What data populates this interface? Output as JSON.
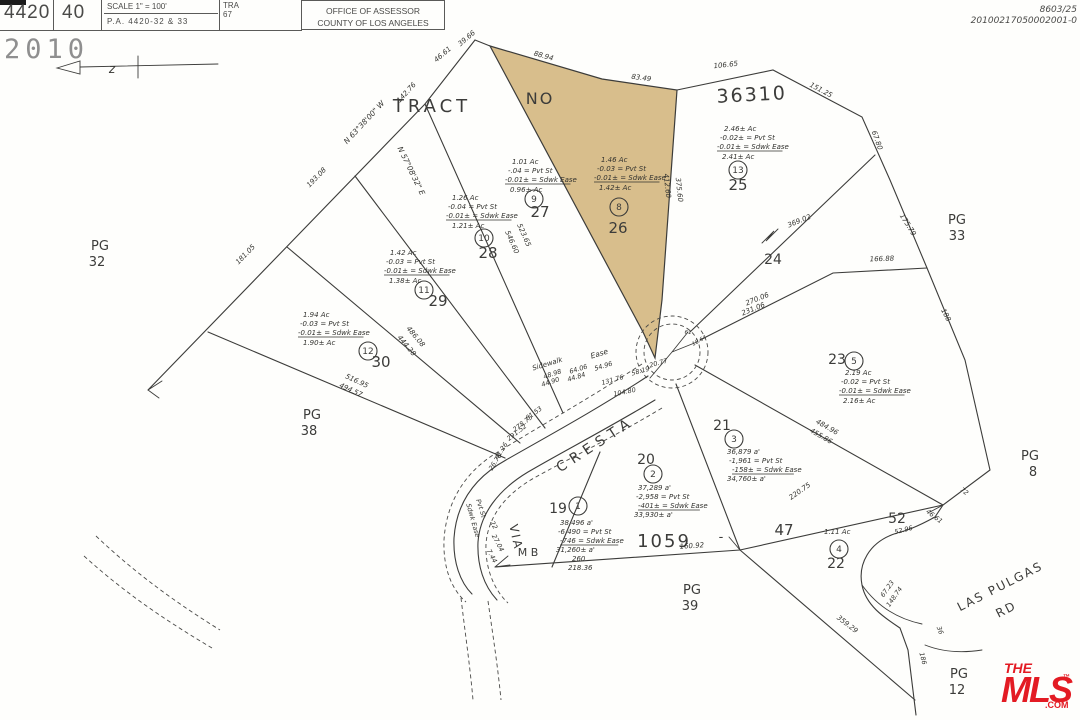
{
  "header": {
    "book": "4420",
    "page": "40",
    "scale": "SCALE 1\" = 100'",
    "pa": "P.A.  4420-32 & 33",
    "tra_label": "TRA",
    "tra_value": "67",
    "office_line1": "OFFICE OF ASSESSOR",
    "office_line2": "COUNTY OF LOS ANGELES"
  },
  "stamp": {
    "year": "2010"
  },
  "doc_numbers": {
    "line1": "8603/25",
    "line2": "20100217050002001-0"
  },
  "mls_logo": {
    "the": "THE",
    "mls": "MLS",
    "tm": "™",
    "com": ".COM",
    "color": "#e31b23"
  },
  "map": {
    "highlight_color": "#d8be8c",
    "line_color": "#3c3c3a",
    "labels": [
      {
        "t": "TRACT",
        "x": 432,
        "y": 112,
        "fs": 18,
        "p": true,
        "ls": 4,
        "a": "m",
        "n": "tract-word"
      },
      {
        "t": "NO",
        "x": 540,
        "y": 104,
        "fs": 16,
        "p": true,
        "ls": 2,
        "a": "m",
        "n": "tract-no-word"
      },
      {
        "t": "36310",
        "x": 752,
        "y": 101,
        "fs": 19,
        "p": true,
        "ls": 2,
        "r": -3,
        "a": "m",
        "n": "tract-number"
      },
      {
        "t": "PG",
        "x": 100,
        "y": 250,
        "fs": 13,
        "p": true,
        "a": "m"
      },
      {
        "t": "32",
        "x": 97,
        "y": 266,
        "fs": 13,
        "p": true,
        "a": "m"
      },
      {
        "t": "PG",
        "x": 957,
        "y": 224,
        "fs": 13,
        "p": true,
        "a": "m"
      },
      {
        "t": "33",
        "x": 957,
        "y": 240,
        "fs": 13,
        "p": true,
        "a": "m"
      },
      {
        "t": "PG",
        "x": 312,
        "y": 419,
        "fs": 13,
        "p": true,
        "a": "m"
      },
      {
        "t": "38",
        "x": 309,
        "y": 435,
        "fs": 13,
        "p": true,
        "a": "m"
      },
      {
        "t": "PG",
        "x": 692,
        "y": 594,
        "fs": 13,
        "p": true,
        "a": "m"
      },
      {
        "t": "39",
        "x": 690,
        "y": 610,
        "fs": 13,
        "p": true,
        "a": "m"
      },
      {
        "t": "PG",
        "x": 1030,
        "y": 460,
        "fs": 13,
        "p": true,
        "a": "m"
      },
      {
        "t": "8",
        "x": 1033,
        "y": 476,
        "fs": 13,
        "p": true,
        "a": "m"
      },
      {
        "t": "PG",
        "x": 959,
        "y": 678,
        "fs": 13,
        "p": true,
        "a": "m"
      },
      {
        "t": "12",
        "x": 957,
        "y": 694,
        "fs": 13,
        "p": true,
        "a": "m"
      },
      {
        "t": "24",
        "x": 773,
        "y": 264,
        "fs": 14,
        "p": true,
        "a": "m",
        "n": "lot-24-number"
      },
      {
        "t": "25",
        "x": 738,
        "y": 190,
        "fs": 15,
        "p": true,
        "a": "m",
        "n": "lot-25-number"
      },
      {
        "t": "26",
        "x": 618,
        "y": 233,
        "fs": 15,
        "p": true,
        "a": "m",
        "n": "lot-26-number"
      },
      {
        "t": "27",
        "x": 540,
        "y": 217,
        "fs": 15,
        "p": true,
        "a": "m",
        "n": "lot-27-number"
      },
      {
        "t": "28",
        "x": 488,
        "y": 258,
        "fs": 15,
        "p": true,
        "a": "m",
        "n": "lot-28-number"
      },
      {
        "t": "29",
        "x": 438,
        "y": 306,
        "fs": 15,
        "p": true,
        "a": "m",
        "n": "lot-29-number"
      },
      {
        "t": "30",
        "x": 381,
        "y": 367,
        "fs": 15,
        "p": true,
        "a": "m",
        "n": "lot-30-number"
      },
      {
        "t": "23",
        "x": 837,
        "y": 364,
        "fs": 14,
        "p": true,
        "a": "m",
        "n": "lot-23-number"
      },
      {
        "t": "22",
        "x": 836,
        "y": 568,
        "fs": 14,
        "p": true,
        "a": "m",
        "n": "lot-22-number"
      },
      {
        "t": "19",
        "x": 558,
        "y": 513,
        "fs": 14,
        "p": true,
        "a": "m",
        "n": "lot-19-number"
      },
      {
        "t": "20",
        "x": 646,
        "y": 464,
        "fs": 14,
        "p": true,
        "a": "m",
        "n": "lot-20-number"
      },
      {
        "t": "21",
        "x": 722,
        "y": 430,
        "fs": 14,
        "p": true,
        "a": "m",
        "n": "lot-21-number"
      },
      {
        "t": "47",
        "x": 784,
        "y": 535,
        "fs": 15,
        "p": true,
        "a": "m"
      },
      {
        "t": "52",
        "x": 897,
        "y": 523,
        "fs": 14,
        "p": true,
        "a": "m"
      },
      {
        "t": "1059",
        "x": 664,
        "y": 547,
        "fs": 18,
        "p": true,
        "ls": 2,
        "a": "m",
        "n": "map-book-number-1059"
      },
      {
        "t": "M B",
        "x": 528,
        "y": 556,
        "fs": 11,
        "p": true,
        "a": "m",
        "n": "map-book-label"
      },
      {
        "t": "-",
        "x": 721,
        "y": 541,
        "fs": 13,
        "p": true,
        "a": "m"
      },
      {
        "t": "VIA",
        "x": 512,
        "y": 538,
        "fs": 12,
        "p": true,
        "r": 78,
        "ls": 2,
        "a": "m",
        "n": "street-via"
      },
      {
        "t": "CRESTA",
        "x": 598,
        "y": 448,
        "fs": 14,
        "p": true,
        "r": -33,
        "ls": 6,
        "a": "m",
        "n": "street-cresta"
      },
      {
        "t": "LAS PULGAS",
        "x": 1002,
        "y": 590,
        "fs": 12,
        "p": true,
        "r": -27,
        "ls": 2,
        "a": "m",
        "n": "street-las-pulgas"
      },
      {
        "t": "RD",
        "x": 1008,
        "y": 613,
        "fs": 12,
        "p": true,
        "r": -27,
        "ls": 2,
        "a": "m"
      },
      {
        "t": "z",
        "x": 112,
        "y": 73,
        "fs": 12,
        "a": "m"
      },
      {
        "t": "9",
        "x": 534,
        "y": 202,
        "fs": 9,
        "p": true,
        "a": "m",
        "c": 9
      },
      {
        "t": "8",
        "x": 619,
        "y": 210,
        "fs": 9,
        "p": true,
        "a": "m",
        "c": 9
      },
      {
        "t": "13",
        "x": 738,
        "y": 173,
        "fs": 9,
        "p": true,
        "a": "m",
        "c": 9
      },
      {
        "t": "10",
        "x": 484,
        "y": 241,
        "fs": 9,
        "p": true,
        "a": "m",
        "c": 9
      },
      {
        "t": "11",
        "x": 424,
        "y": 293,
        "fs": 9,
        "p": true,
        "a": "m",
        "c": 9
      },
      {
        "t": "12",
        "x": 368,
        "y": 354,
        "fs": 9,
        "p": true,
        "a": "m",
        "c": 9
      },
      {
        "t": "5",
        "x": 854,
        "y": 364,
        "fs": 9,
        "p": true,
        "a": "m",
        "c": 9
      },
      {
        "t": "4",
        "x": 839,
        "y": 552,
        "fs": 9,
        "p": true,
        "a": "m",
        "c": 9
      },
      {
        "t": "1",
        "x": 578,
        "y": 509,
        "fs": 9,
        "p": true,
        "a": "m",
        "c": 9
      },
      {
        "t": "2",
        "x": 653,
        "y": 477,
        "fs": 9,
        "p": true,
        "a": "m",
        "c": 9
      },
      {
        "t": "3",
        "x": 734,
        "y": 442,
        "fs": 9,
        "p": true,
        "a": "m",
        "c": 9
      },
      {
        "t": "1.01 Ac",
        "x": 512,
        "y": 164,
        "a": "s"
      },
      {
        "t": "-.04 = Pvt St",
        "x": 508,
        "y": 173,
        "a": "s"
      },
      {
        "t": "-0.01± = Sdwk Ease",
        "x": 505,
        "y": 182,
        "a": "s",
        "ul": true
      },
      {
        "t": "0.96± Ac",
        "x": 510,
        "y": 192,
        "a": "s"
      },
      {
        "t": "1.46 Ac",
        "x": 601,
        "y": 162,
        "a": "s"
      },
      {
        "t": "-0.03 = Pvt St",
        "x": 597,
        "y": 171,
        "a": "s"
      },
      {
        "t": "-0.01± = Sdwk Ease",
        "x": 594,
        "y": 180,
        "a": "s",
        "ul": true
      },
      {
        "t": "1.42± Ac",
        "x": 599,
        "y": 190,
        "a": "s"
      },
      {
        "t": "2.46± Ac",
        "x": 724,
        "y": 131,
        "a": "s"
      },
      {
        "t": "-0.02± = Pvt St",
        "x": 720,
        "y": 140,
        "a": "s"
      },
      {
        "t": "-0.01± = Sdwk Ease",
        "x": 717,
        "y": 149,
        "a": "s",
        "ul": true
      },
      {
        "t": "2.41± Ac",
        "x": 722,
        "y": 159,
        "a": "s"
      },
      {
        "t": "1.26 Ac",
        "x": 452,
        "y": 200,
        "a": "s"
      },
      {
        "t": "-0.04 = Pvt St",
        "x": 448,
        "y": 209,
        "a": "s"
      },
      {
        "t": "-0.01± = Sdwk Ease",
        "x": 446,
        "y": 218,
        "a": "s",
        "ul": true
      },
      {
        "t": "1.21± Ac",
        "x": 452,
        "y": 228,
        "a": "s"
      },
      {
        "t": "1.42 Ac",
        "x": 390,
        "y": 255,
        "a": "s"
      },
      {
        "t": "-0.03 = Pvt St",
        "x": 386,
        "y": 264,
        "a": "s"
      },
      {
        "t": "-0.01± = Sdwk Ease",
        "x": 384,
        "y": 273,
        "a": "s",
        "ul": true
      },
      {
        "t": "1.38± Ac",
        "x": 389,
        "y": 283,
        "a": "s"
      },
      {
        "t": "1.94 Ac",
        "x": 303,
        "y": 317,
        "a": "s"
      },
      {
        "t": "-0.03 = Pvt St",
        "x": 300,
        "y": 326,
        "a": "s"
      },
      {
        "t": "-0.01± = Sdwk Ease",
        "x": 298,
        "y": 335,
        "a": "s",
        "ul": true
      },
      {
        "t": "1.90± Ac",
        "x": 303,
        "y": 345,
        "a": "s"
      },
      {
        "t": "2.19 Ac",
        "x": 845,
        "y": 375,
        "a": "s"
      },
      {
        "t": "-0.02 = Pvt St",
        "x": 841,
        "y": 384,
        "a": "s"
      },
      {
        "t": "-0.01± = Sdwk Ease",
        "x": 839,
        "y": 393,
        "a": "s",
        "ul": true
      },
      {
        "t": "2.16± Ac",
        "x": 843,
        "y": 403,
        "a": "s"
      },
      {
        "t": "1.11 Ac",
        "x": 824,
        "y": 534,
        "a": "s"
      },
      {
        "t": "38,496 a'",
        "x": 560,
        "y": 525,
        "a": "s"
      },
      {
        "t": "-6,490 = Pvt St",
        "x": 558,
        "y": 534,
        "a": "s"
      },
      {
        "t": "-746 = Sdwk Ease",
        "x": 560,
        "y": 543,
        "a": "s",
        "ul": true
      },
      {
        "t": "31,260± a'",
        "x": 556,
        "y": 552,
        "a": "s"
      },
      {
        "t": "260",
        "x": 572,
        "y": 561,
        "a": "s"
      },
      {
        "t": "218.36",
        "x": 568,
        "y": 570,
        "a": "s"
      },
      {
        "t": "37,289 a'",
        "x": 638,
        "y": 490,
        "a": "s"
      },
      {
        "t": "-2,958 = Pvt St",
        "x": 636,
        "y": 499,
        "a": "s"
      },
      {
        "t": "-401± = Sdwk Ease",
        "x": 638,
        "y": 508,
        "a": "s",
        "ul": true
      },
      {
        "t": "33,930± a'",
        "x": 634,
        "y": 517,
        "a": "s"
      },
      {
        "t": "36,879 a'",
        "x": 727,
        "y": 454,
        "a": "s"
      },
      {
        "t": "-1,961 = Pvt St",
        "x": 729,
        "y": 463,
        "a": "s"
      },
      {
        "t": "-158± = Sdwk Ease",
        "x": 732,
        "y": 472,
        "a": "s",
        "ul": true
      },
      {
        "t": "34,760± a'",
        "x": 727,
        "y": 481,
        "a": "s"
      },
      {
        "t": "46.61",
        "x": 444,
        "y": 56,
        "r": -40,
        "a": "m"
      },
      {
        "t": "39.66",
        "x": 468,
        "y": 40,
        "r": -40,
        "a": "m"
      },
      {
        "t": "142.76",
        "x": 408,
        "y": 94,
        "r": -47,
        "a": "m"
      },
      {
        "t": "N 63°38'00\" W",
        "x": 366,
        "y": 124,
        "fs": 7.5,
        "r": -47,
        "a": "m"
      },
      {
        "t": "193.08",
        "x": 318,
        "y": 179,
        "r": -46,
        "a": "m"
      },
      {
        "t": "181.05",
        "x": 247,
        "y": 256,
        "r": -46,
        "a": "m"
      },
      {
        "t": "N 57°08'32\" E",
        "x": 409,
        "y": 172,
        "fs": 7.5,
        "r": 64,
        "a": "m"
      },
      {
        "t": "88.94",
        "x": 543,
        "y": 58,
        "r": 16,
        "a": "m"
      },
      {
        "t": "83.49",
        "x": 641,
        "y": 80,
        "r": 8,
        "a": "m"
      },
      {
        "t": "106.65",
        "x": 726,
        "y": 67,
        "r": -6,
        "a": "m"
      },
      {
        "t": "151.25",
        "x": 820,
        "y": 92,
        "r": 28,
        "a": "m"
      },
      {
        "t": "67.80",
        "x": 875,
        "y": 141,
        "r": 70,
        "a": "m"
      },
      {
        "t": "175.79",
        "x": 906,
        "y": 226,
        "r": 58,
        "a": "m"
      },
      {
        "t": "166.88",
        "x": 882,
        "y": 261,
        "r": -2,
        "a": "m"
      },
      {
        "t": "188",
        "x": 944,
        "y": 316,
        "r": 62,
        "a": "m"
      },
      {
        "t": "369.02",
        "x": 800,
        "y": 223,
        "r": -22,
        "a": "m"
      },
      {
        "t": "270.06",
        "x": 758,
        "y": 301,
        "r": -22,
        "a": "m"
      },
      {
        "t": "231.06",
        "x": 754,
        "y": 311,
        "r": -22,
        "a": "m"
      },
      {
        "t": "412.60",
        "x": 665,
        "y": 186,
        "r": 84,
        "a": "m"
      },
      {
        "t": "375.60",
        "x": 677,
        "y": 190,
        "r": 84,
        "a": "m"
      },
      {
        "t": "546.60",
        "x": 510,
        "y": 243,
        "r": 66,
        "a": "m"
      },
      {
        "t": "523.65",
        "x": 522,
        "y": 236,
        "r": 66,
        "a": "m"
      },
      {
        "t": "486.08",
        "x": 414,
        "y": 338,
        "r": 50,
        "a": "m"
      },
      {
        "t": "444.28",
        "x": 405,
        "y": 347,
        "r": 50,
        "a": "m"
      },
      {
        "t": "516.95",
        "x": 356,
        "y": 383,
        "r": 25,
        "a": "m"
      },
      {
        "t": "494.57",
        "x": 350,
        "y": 392,
        "r": 25,
        "a": "m"
      },
      {
        "t": "131.76",
        "x": 613,
        "y": 382,
        "fs": 6.5,
        "r": -16,
        "a": "m"
      },
      {
        "t": "104.80",
        "x": 625,
        "y": 394,
        "fs": 6.5,
        "r": -12,
        "a": "m"
      },
      {
        "t": "58.19",
        "x": 641,
        "y": 373,
        "fs": 6.5,
        "r": -16,
        "a": "m"
      },
      {
        "t": "20.77",
        "x": 659,
        "y": 365,
        "fs": 6.5,
        "r": -16,
        "a": "m"
      },
      {
        "t": "48.98",
        "x": 553,
        "y": 376,
        "fs": 6.5,
        "r": -18,
        "a": "m"
      },
      {
        "t": "44.90",
        "x": 551,
        "y": 384,
        "fs": 6.5,
        "r": -18,
        "a": "m"
      },
      {
        "t": "64.06",
        "x": 579,
        "y": 371,
        "fs": 6.5,
        "r": -17,
        "a": "m"
      },
      {
        "t": "44.84",
        "x": 577,
        "y": 379,
        "fs": 6.5,
        "r": -17,
        "a": "m"
      },
      {
        "t": "54.96",
        "x": 604,
        "y": 368,
        "fs": 6.5,
        "r": -17,
        "a": "m"
      },
      {
        "t": "Sidewalk",
        "x": 548,
        "y": 366,
        "fs": 7,
        "r": -17,
        "a": "m"
      },
      {
        "t": "Ease",
        "x": 600,
        "y": 356,
        "fs": 7.5,
        "r": -17,
        "a": "m"
      },
      {
        "t": "61.53",
        "x": 535,
        "y": 415,
        "fs": 6.5,
        "r": -36,
        "a": "m"
      },
      {
        "t": "278.75",
        "x": 524,
        "y": 425,
        "fs": 6.5,
        "r": -38,
        "a": "m"
      },
      {
        "t": "291.52",
        "x": 518,
        "y": 434,
        "fs": 6.5,
        "r": -38,
        "a": "m"
      },
      {
        "t": "41.26",
        "x": 503,
        "y": 452,
        "fs": 6.5,
        "r": -58,
        "a": "m"
      },
      {
        "t": "26.78",
        "x": 497,
        "y": 463,
        "fs": 6.5,
        "r": -58,
        "a": "m"
      },
      {
        "t": "Pvt St",
        "x": 479,
        "y": 509,
        "fs": 6.5,
        "r": 72,
        "a": "m"
      },
      {
        "t": "Sdwk Ease",
        "x": 471,
        "y": 521,
        "fs": 6.5,
        "r": 74,
        "a": "m"
      },
      {
        "t": "22",
        "x": 492,
        "y": 526,
        "fs": 6.5,
        "r": 62,
        "a": "m"
      },
      {
        "t": "27.04",
        "x": 496,
        "y": 544,
        "fs": 6.5,
        "r": 62,
        "a": "m"
      },
      {
        "t": "7.44",
        "x": 490,
        "y": 557,
        "fs": 6.5,
        "r": 62,
        "a": "m"
      },
      {
        "t": "160.92",
        "x": 692,
        "y": 548,
        "r": -4,
        "a": "m"
      },
      {
        "t": "220.75",
        "x": 801,
        "y": 493,
        "r": -35,
        "a": "m"
      },
      {
        "t": "359.29",
        "x": 846,
        "y": 626,
        "r": 38,
        "a": "m"
      },
      {
        "t": "52.96",
        "x": 904,
        "y": 532,
        "fs": 6.5,
        "r": -14,
        "a": "m"
      },
      {
        "t": "46.61",
        "x": 933,
        "y": 518,
        "fs": 6.5,
        "r": 38,
        "a": "m"
      },
      {
        "t": "72",
        "x": 963,
        "y": 493,
        "fs": 6.5,
        "r": 38,
        "a": "m"
      },
      {
        "t": "67.23",
        "x": 889,
        "y": 590,
        "fs": 6.5,
        "r": -55,
        "a": "m"
      },
      {
        "t": "148.74",
        "x": 896,
        "y": 598,
        "fs": 6.5,
        "r": -55,
        "a": "m"
      },
      {
        "t": "36",
        "x": 938,
        "y": 631,
        "fs": 6.5,
        "r": 70,
        "a": "m"
      },
      {
        "t": "186",
        "x": 921,
        "y": 659,
        "fs": 6.5,
        "r": 75,
        "a": "m"
      },
      {
        "t": "484.96",
        "x": 826,
        "y": 429,
        "r": 30,
        "a": "m"
      },
      {
        "t": "455.86",
        "x": 820,
        "y": 438,
        "r": 30,
        "a": "m"
      },
      {
        "t": "61",
        "x": 688,
        "y": 334,
        "fs": 5.5,
        "a": "m"
      },
      {
        "t": "18.64",
        "x": 700,
        "y": 342,
        "fs": 5.5,
        "r": -30,
        "a": "m"
      }
    ]
  }
}
